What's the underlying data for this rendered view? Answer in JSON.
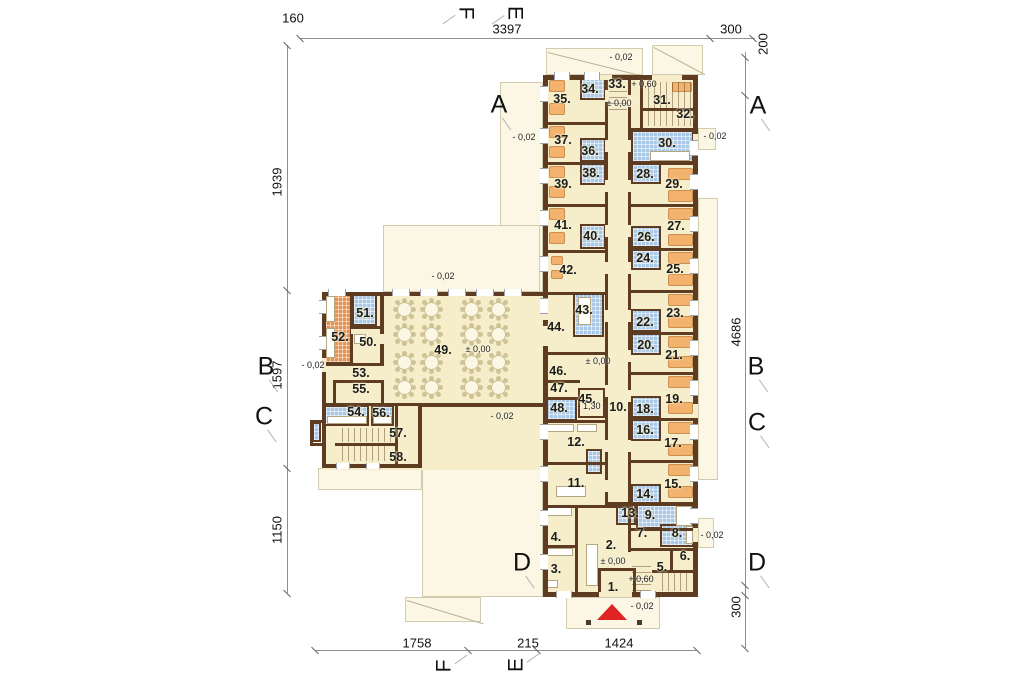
{
  "plan": {
    "colors": {
      "wall": "#5e3c22",
      "floor": "#f6eecb",
      "pale": "#fbf7e4",
      "tile_blue": "#a9c7e6",
      "kitchen_orange": "#e8914e",
      "bed_orange": "#f3b26e",
      "entrance_red": "#e02424"
    },
    "rooms": [
      {
        "label": "1.",
        "x": 613,
        "y": 587
      },
      {
        "label": "2.",
        "x": 611,
        "y": 545
      },
      {
        "label": "3.",
        "x": 556,
        "y": 569
      },
      {
        "label": "4.",
        "x": 556,
        "y": 537
      },
      {
        "label": "5.",
        "x": 662,
        "y": 567
      },
      {
        "label": "6.",
        "x": 685,
        "y": 556
      },
      {
        "label": "7.",
        "x": 642,
        "y": 533
      },
      {
        "label": "8.",
        "x": 677,
        "y": 533
      },
      {
        "label": "9.",
        "x": 650,
        "y": 515
      },
      {
        "label": "10.",
        "x": 618,
        "y": 407
      },
      {
        "label": "11.",
        "x": 576,
        "y": 483
      },
      {
        "label": "12.",
        "x": 576,
        "y": 442
      },
      {
        "label": "13.",
        "x": 630,
        "y": 513
      },
      {
        "label": "14.",
        "x": 645,
        "y": 494
      },
      {
        "label": "15.",
        "x": 673,
        "y": 484
      },
      {
        "label": "16.",
        "x": 645,
        "y": 430
      },
      {
        "label": "17.",
        "x": 673,
        "y": 443
      },
      {
        "label": "18.",
        "x": 645,
        "y": 409
      },
      {
        "label": "19.",
        "x": 674,
        "y": 399
      },
      {
        "label": "20.",
        "x": 646,
        "y": 345
      },
      {
        "label": "21.",
        "x": 674,
        "y": 355
      },
      {
        "label": "22.",
        "x": 645,
        "y": 322
      },
      {
        "label": "23.",
        "x": 675,
        "y": 313
      },
      {
        "label": "24.",
        "x": 645,
        "y": 258
      },
      {
        "label": "25.",
        "x": 675,
        "y": 269
      },
      {
        "label": "26.",
        "x": 646,
        "y": 237
      },
      {
        "label": "27.",
        "x": 676,
        "y": 226
      },
      {
        "label": "28.",
        "x": 645,
        "y": 174
      },
      {
        "label": "29.",
        "x": 674,
        "y": 184
      },
      {
        "label": "30.",
        "x": 667,
        "y": 143
      },
      {
        "label": "31.",
        "x": 662,
        "y": 100
      },
      {
        "label": "32.",
        "x": 685,
        "y": 114
      },
      {
        "label": "33.",
        "x": 617,
        "y": 84
      },
      {
        "label": "34.",
        "x": 590,
        "y": 89
      },
      {
        "label": "35.",
        "x": 562,
        "y": 99
      },
      {
        "label": "36.",
        "x": 590,
        "y": 151
      },
      {
        "label": "37.",
        "x": 563,
        "y": 140
      },
      {
        "label": "38.",
        "x": 591,
        "y": 173
      },
      {
        "label": "39.",
        "x": 563,
        "y": 184
      },
      {
        "label": "40.",
        "x": 592,
        "y": 236
      },
      {
        "label": "41.",
        "x": 563,
        "y": 225
      },
      {
        "label": "42.",
        "x": 568,
        "y": 270
      },
      {
        "label": "43.",
        "x": 584,
        "y": 310
      },
      {
        "label": "44.",
        "x": 556,
        "y": 327
      },
      {
        "label": "45.",
        "x": 587,
        "y": 399
      },
      {
        "label": "46.",
        "x": 558,
        "y": 371
      },
      {
        "label": "47.",
        "x": 559,
        "y": 388
      },
      {
        "label": "48.",
        "x": 559,
        "y": 408
      },
      {
        "label": "49.",
        "x": 443,
        "y": 350
      },
      {
        "label": "50.",
        "x": 368,
        "y": 342
      },
      {
        "label": "51.",
        "x": 365,
        "y": 313
      },
      {
        "label": "52.",
        "x": 340,
        "y": 337
      },
      {
        "label": "53.",
        "x": 361,
        "y": 373
      },
      {
        "label": "54.",
        "x": 356,
        "y": 412
      },
      {
        "label": "55.",
        "x": 361,
        "y": 389
      },
      {
        "label": "56.",
        "x": 381,
        "y": 413
      },
      {
        "label": "57.",
        "x": 398,
        "y": 433
      },
      {
        "label": "58.",
        "x": 398,
        "y": 457
      }
    ],
    "levels": [
      {
        "label": "- 0,02",
        "x": 621,
        "y": 57
      },
      {
        "label": "+ 0,60",
        "x": 644,
        "y": 84
      },
      {
        "label": "± 0,00",
        "x": 619,
        "y": 103
      },
      {
        "label": "- 0,02",
        "x": 524,
        "y": 137
      },
      {
        "label": "- 0,02",
        "x": 715,
        "y": 136
      },
      {
        "label": "- 0,02",
        "x": 443,
        "y": 276
      },
      {
        "label": "± 0,00",
        "x": 478,
        "y": 349
      },
      {
        "label": "- 0,02",
        "x": 313,
        "y": 365
      },
      {
        "label": "± 0,00",
        "x": 598,
        "y": 361
      },
      {
        "label": "- 1,30",
        "x": 589,
        "y": 406
      },
      {
        "label": "- 0,02",
        "x": 502,
        "y": 416
      },
      {
        "label": "- 0,02",
        "x": 712,
        "y": 535
      },
      {
        "label": "± 0,00",
        "x": 613,
        "y": 561
      },
      {
        "label": "+ 0,60",
        "x": 641,
        "y": 579
      },
      {
        "label": "- 0,02",
        "x": 642,
        "y": 606
      }
    ],
    "dimensions": [
      {
        "label": "160",
        "x": 293,
        "y": 18,
        "rot": 0
      },
      {
        "label": "3397",
        "x": 507,
        "y": 29,
        "rot": 0
      },
      {
        "label": "300",
        "x": 731,
        "y": 29,
        "rot": 0
      },
      {
        "label": "200",
        "x": 763,
        "y": 44,
        "rot": 1
      },
      {
        "label": "4686",
        "x": 736,
        "y": 332,
        "rot": 1
      },
      {
        "label": "300",
        "x": 736,
        "y": 607,
        "rot": 1
      },
      {
        "label": "1939",
        "x": 277,
        "y": 182,
        "rot": 1
      },
      {
        "label": "1597",
        "x": 277,
        "y": 375,
        "rot": 1
      },
      {
        "label": "1150",
        "x": 277,
        "y": 530,
        "rot": 1
      },
      {
        "label": "1758",
        "x": 417,
        "y": 643,
        "rot": 0
      },
      {
        "label": "215",
        "x": 528,
        "y": 643,
        "rot": 0
      },
      {
        "label": "1424",
        "x": 619,
        "y": 643,
        "rot": 0
      }
    ],
    "section_markers": [
      {
        "label": "A",
        "x": 499,
        "y": 105,
        "rot": "none"
      },
      {
        "label": "A",
        "x": 758,
        "y": 106,
        "rot": "none"
      },
      {
        "label": "B",
        "x": 266,
        "y": 367,
        "rot": "none"
      },
      {
        "label": "B",
        "x": 756,
        "y": 367,
        "rot": "none"
      },
      {
        "label": "C",
        "x": 264,
        "y": 417,
        "rot": "none"
      },
      {
        "label": "C",
        "x": 757,
        "y": 423,
        "rot": "none"
      },
      {
        "label": "D",
        "x": 522,
        "y": 563,
        "rot": "none"
      },
      {
        "label": "D",
        "x": 757,
        "y": 563,
        "rot": "none"
      },
      {
        "label": "F",
        "x": 466,
        "y": 13,
        "rot": "cw"
      },
      {
        "label": "E",
        "x": 515,
        "y": 13,
        "rot": "cw"
      },
      {
        "label": "F",
        "x": 444,
        "y": 666,
        "rot": "ccw"
      },
      {
        "label": "E",
        "x": 516,
        "y": 665,
        "rot": "ccw"
      }
    ]
  }
}
